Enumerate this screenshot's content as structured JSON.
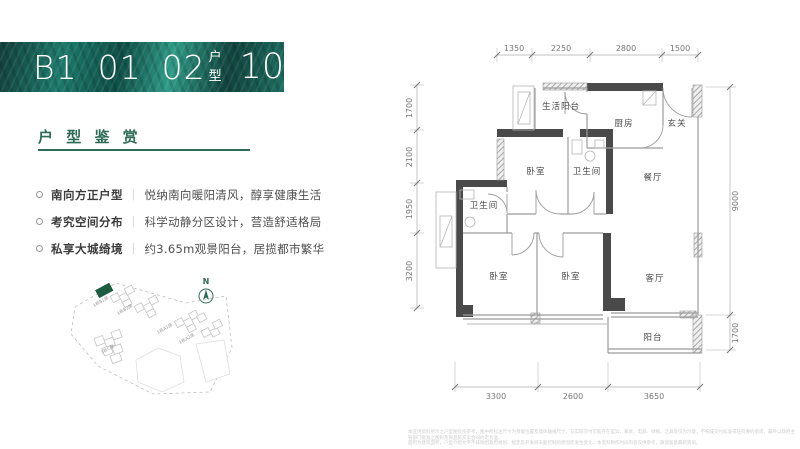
{
  "header": {
    "code": "B1",
    "num1": "01",
    "num2": "02",
    "type_label": "户型",
    "area_value": "105",
    "area_note": "建面约",
    "area_unit": "m",
    "area_exp": "2"
  },
  "section": {
    "title": "户 型 鉴 赏"
  },
  "features": [
    {
      "title": "南向方正户型",
      "divider": "｜",
      "desc": "悦纳南向暖阳清风，醇享健康生活"
    },
    {
      "title": "考究空间分布",
      "divider": "｜",
      "desc": "科学动静分区设计，营造舒适格局"
    },
    {
      "title": "私享大城绮境",
      "divider": "｜",
      "desc": "约3.65m观景阳台，居揽都市繁华"
    }
  ],
  "siteplan": {
    "north": "N",
    "labels": [
      "1栋B1座",
      "1栋B2座",
      "1栋C座",
      "1栋A1座",
      "1栋A2座"
    ],
    "highlight_color": "#1d5c40"
  },
  "plan": {
    "rooms": {
      "life_balcony": "生活阳台",
      "kitchen": "厨房",
      "foyer": "玄关",
      "bedroom_top": "卧室",
      "bath_top": "卫生间",
      "bath_left": "卫生间",
      "dining": "餐厅",
      "bedroom_left": "卧室",
      "bedroom_mid": "卧室",
      "living": "客厅",
      "balcony": "阳台"
    },
    "dims": {
      "top": [
        "1350",
        "2250",
        "2800",
        "1500"
      ],
      "left": [
        "1700",
        "2100",
        "1950",
        "3200"
      ],
      "right": [
        "9000",
        "1700"
      ],
      "bottom": [
        "3300",
        "2600",
        "3650"
      ]
    }
  },
  "footer": {
    "line1": "本宣传资料所示之户型图仅作参考，图中所标注尺寸为预留位置及墙体轴线尺寸，与实际交付可能存在差异；家具、电器、绿植、洁具等仅为示意，不构成交付标准或任何要约承诺，最终以政府主管部门批准之图则及商品房买卖合同约定为准。",
    "line2": "面积为建筑面积，户型介绍文字不排除因政府规划、规定及开发商未能控制的原因而发生变化，本资料制作时间内容仅供参考，敬请留意最新资讯。"
  },
  "colors": {
    "accent_green": "#2e6b57",
    "wall_dark": "#4a4a4a",
    "banner_teal": "#1d7a6c"
  }
}
